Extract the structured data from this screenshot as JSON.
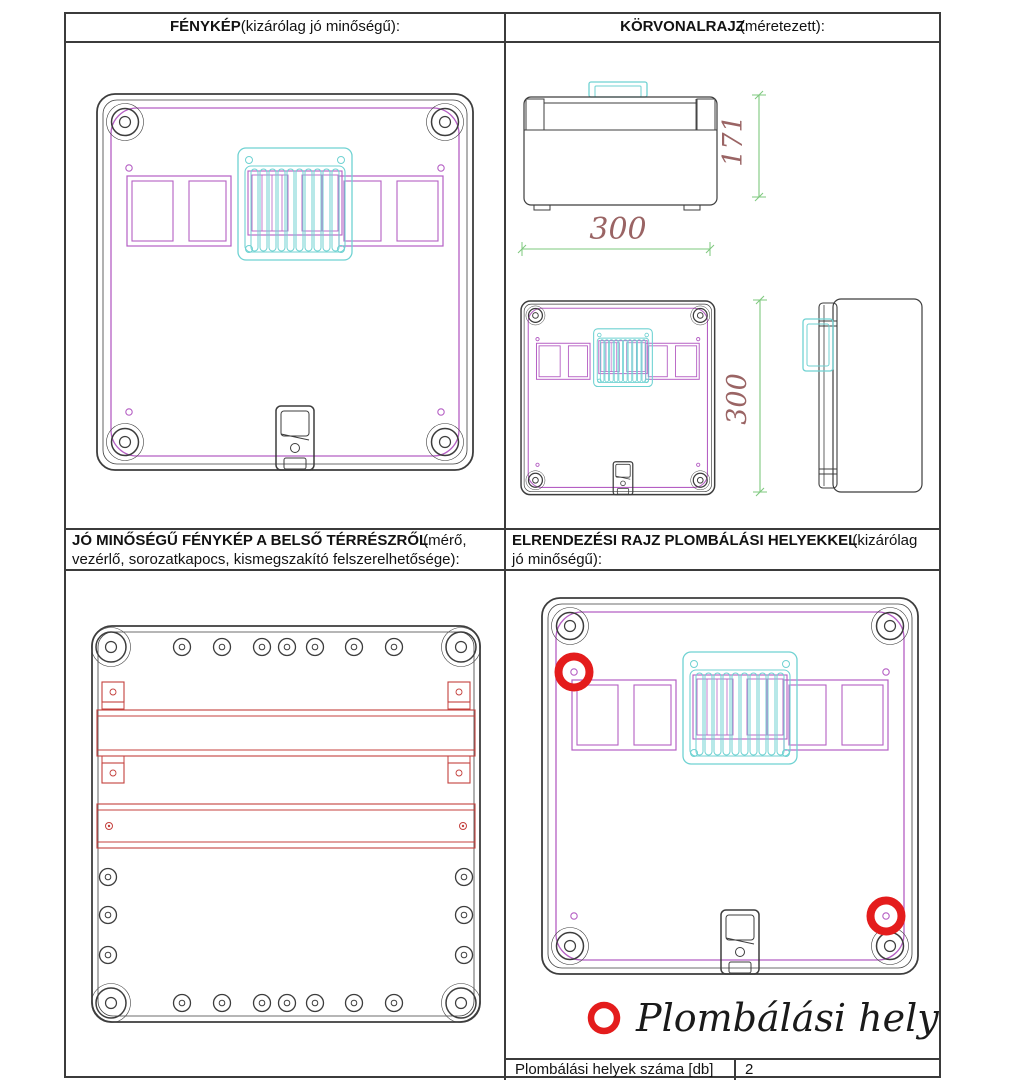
{
  "colors": {
    "line": "#3d3d3d",
    "magenta": "#b55fc4",
    "cyan": "#6fd2d2",
    "rail_red": "#c4403d",
    "marker_red": "#e41c1c",
    "dim_green": "#7ec87e",
    "dim_text": "#9a6464",
    "text": "#121212"
  },
  "cells": {
    "photo": {
      "title_bold": "FÉNYKÉP",
      "title_rest": "(kizárólag jó minőségű):"
    },
    "outline": {
      "title_bold": "KÖRVONALRAJZ",
      "title_rest": "(méretezett):"
    },
    "interior": {
      "title_bold": "JÓ MINŐSÉGŰ FÉNYKÉP A BELSŐ TÉRRÉSZRŐL",
      "title_rest": "(mérő, vezérlő, sorozatkapocs, kismegszakító felszerelhetősége):"
    },
    "layout": {
      "title_bold": "ELRENDEZÉSI RAJZ PLOMBÁLÁSI HELYEKKEL",
      "title_rest": "(kizárólag jó minőségű):"
    }
  },
  "dimensions": {
    "side_height": "171",
    "width": "300",
    "front_height": "300"
  },
  "legend": {
    "label": "Plombálási hely",
    "marker": "red-circle"
  },
  "footer": {
    "label": "Plombálási helyek száma [db]",
    "value": "2"
  }
}
